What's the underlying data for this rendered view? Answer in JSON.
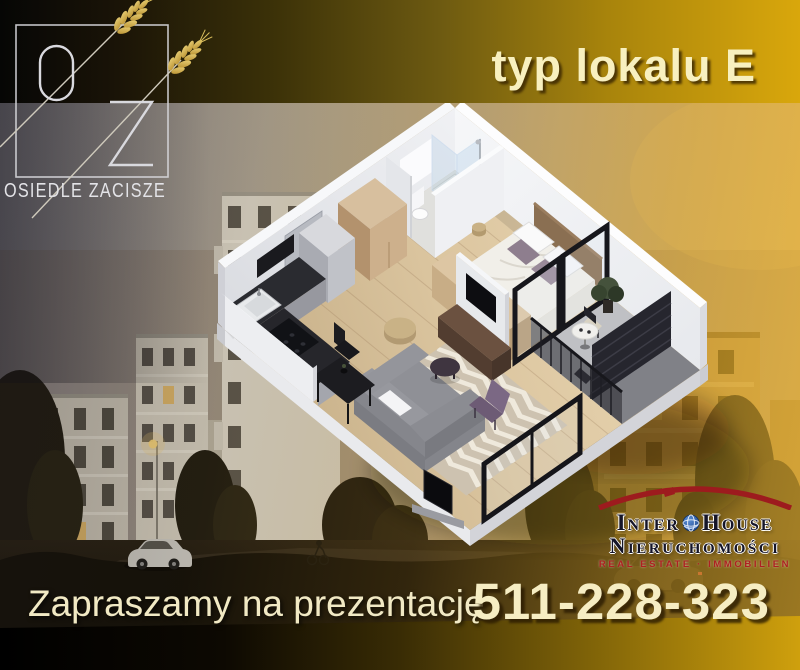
{
  "brand": {
    "monogram_o": "O",
    "monogram_z": "Z",
    "estate_name": "OSIEDLE ZACISZE",
    "wheat_icon": "wheat-stalks-icon"
  },
  "headline": {
    "unit_type": "typ lokalu E"
  },
  "floor_plan": {
    "type": "3d-isometric-apartment",
    "rooms": [
      "bathroom",
      "bedroom",
      "kitchen",
      "living-room",
      "balcony"
    ]
  },
  "agency": {
    "name_inter": "Inter",
    "name_house": "House",
    "globe_icon": "globe-icon",
    "roof_icon": "red-roof-arc-icon",
    "subtitle": "Nieruchomości",
    "tagline": "Real Estate · Immobilien"
  },
  "footer": {
    "invitation": "Zapraszamy na prezentację",
    "phone": "511-228-323"
  },
  "colors": {
    "gold_accent": "#d9a70c",
    "cream_text": "#f6edc3",
    "brand_red": "#9d1b1e",
    "globe_blue": "#2a63b8"
  }
}
